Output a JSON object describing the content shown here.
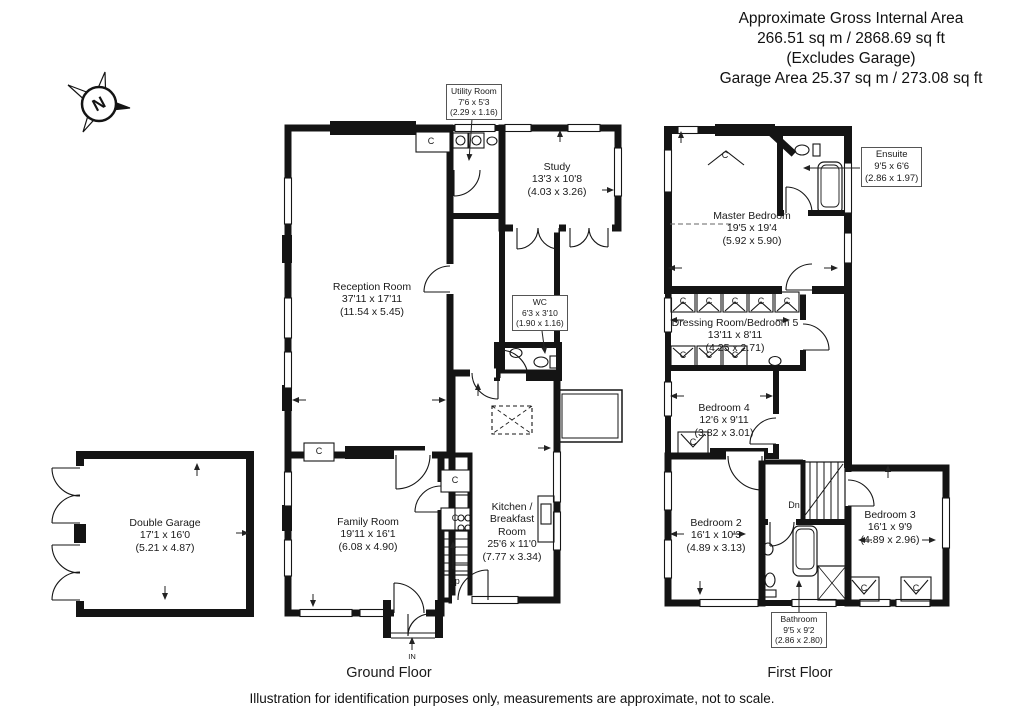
{
  "header": {
    "lines": [
      "Approximate Gross Internal Area",
      "266.51 sq m / 2868.69 sq ft",
      "(Excludes Garage)",
      "Garage Area 25.37 sq m / 273.08 sq ft"
    ]
  },
  "compass": {
    "north": "N"
  },
  "plan_labels": {
    "cupboard": "C",
    "stairs_up": "Up",
    "stairs_down": "Dn",
    "entrance": "IN"
  },
  "ground_floor": {
    "title": "Ground Floor",
    "rooms": {
      "utility": {
        "name": "Utility Room",
        "imperial": "7'6 x 5'3",
        "metric": "(2.29 x 1.16)"
      },
      "study": {
        "name": "Study",
        "imperial": "13'3 x 10'8",
        "metric": "(4.03 x 3.26)"
      },
      "reception": {
        "name": "Reception Room",
        "imperial": "37'11 x 17'11",
        "metric": "(11.54 x 5.45)"
      },
      "wc": {
        "name": "WC",
        "imperial": "6'3 x 3'10",
        "metric": "(1.90 x 1.16)"
      },
      "family": {
        "name": "Family Room",
        "imperial": "19'11 x 16'1",
        "metric": "(6.08 x 4.90)"
      },
      "kitchen": {
        "name": "Kitchen / Breakfast Room",
        "imperial": "25'6 x 11'0",
        "metric": "(7.77 x 3.34)"
      },
      "garage": {
        "name": "Double Garage",
        "imperial": "17'1 x 16'0",
        "metric": "(5.21 x 4.87)"
      }
    }
  },
  "first_floor": {
    "title": "First Floor",
    "rooms": {
      "master": {
        "name": "Master Bedroom",
        "imperial": "19'5 x 19'4",
        "metric": "(5.92 x 5.90)"
      },
      "ensuite": {
        "name": "Ensuite",
        "imperial": "9'5 x 6'6",
        "metric": "(2.86 x 1.97)"
      },
      "dressing": {
        "name": "Dressing Room/Bedroom 5",
        "imperial": "13'11 x 8'11",
        "metric": "(4.25 x 2.71)"
      },
      "bedroom4": {
        "name": "Bedroom 4",
        "imperial": "12'6 x 9'11",
        "metric": "(3.82 x 3.01)"
      },
      "bedroom2": {
        "name": "Bedroom 2",
        "imperial": "16'1 x 10'3",
        "metric": "(4.89 x 3.13)"
      },
      "bedroom3": {
        "name": "Bedroom 3",
        "imperial": "16'1 x 9'9",
        "metric": "(4.89 x 2.96)"
      },
      "bathroom": {
        "name": "Bathroom",
        "imperial": "9'5 x 9'2",
        "metric": "(2.86 x 2.80)"
      }
    }
  },
  "footer": {
    "disclaimer": "Illustration for identification purposes only, measurements are approximate, not to scale."
  }
}
